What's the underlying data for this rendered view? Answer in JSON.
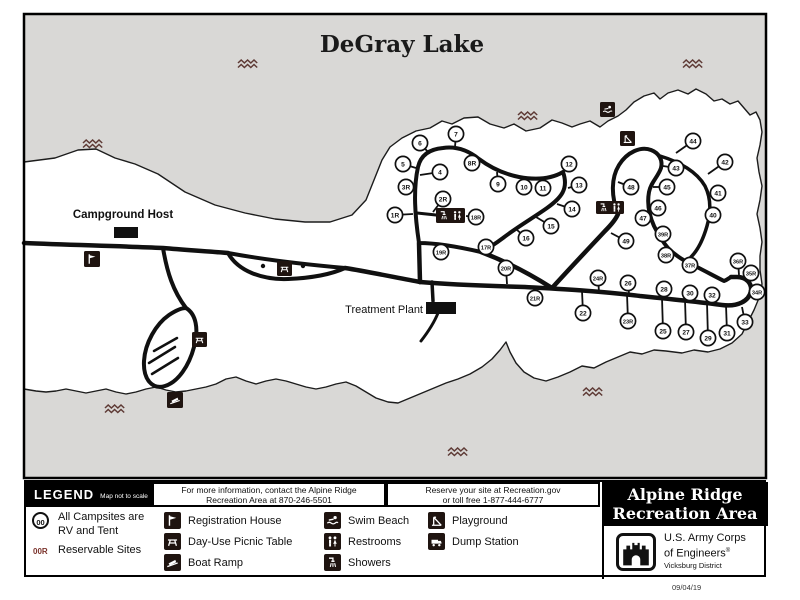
{
  "title": "DeGray Lake",
  "date_stamp": "09/04/19",
  "colors": {
    "lake": "#d9d8d6",
    "land": "#ffffff",
    "road": "#101010",
    "wave": "#5e3a35",
    "reservable": "#7b332c"
  },
  "map": {
    "campground_host_label": "Campground Host",
    "treatment_plant_label": "Treatment Plant",
    "sites": [
      [
        "1R",
        395,
        215,
        413,
        214
      ],
      [
        "2R",
        443,
        199,
        433,
        212
      ],
      [
        "3R",
        406,
        187,
        414,
        189
      ],
      [
        "4",
        440,
        172,
        420,
        175
      ],
      [
        "5",
        403,
        164,
        416,
        168
      ],
      [
        "6",
        420,
        143,
        428,
        152
      ],
      [
        "7",
        456,
        134,
        455,
        147
      ],
      [
        "8R",
        472,
        163,
        470,
        154
      ],
      [
        "9",
        498,
        184,
        497,
        172
      ],
      [
        "10",
        524,
        187,
        522,
        177
      ],
      [
        "11",
        543,
        188,
        543,
        178
      ],
      [
        "12",
        569,
        164,
        564,
        171
      ],
      [
        "13",
        579,
        185,
        568,
        188
      ],
      [
        "14",
        572,
        209,
        557,
        204
      ],
      [
        "15",
        551,
        226,
        536,
        217
      ],
      [
        "16",
        526,
        238,
        516,
        229
      ],
      [
        "17R",
        486,
        247,
        489,
        254
      ],
      [
        "18R",
        476,
        217,
        466,
        216
      ],
      [
        "19R",
        441,
        252,
        440,
        245
      ],
      [
        "20R",
        506,
        268,
        507,
        284
      ],
      [
        "21R",
        535,
        298,
        534,
        288
      ],
      [
        "22",
        583,
        313,
        582,
        291
      ],
      [
        "23R",
        628,
        321,
        627,
        294
      ],
      [
        "24R",
        598,
        278,
        599,
        292
      ],
      [
        "25",
        663,
        331,
        662,
        298
      ],
      [
        "26",
        628,
        283,
        629,
        294
      ],
      [
        "27",
        686,
        332,
        685,
        300
      ],
      [
        "28",
        664,
        289,
        665,
        298
      ],
      [
        "29",
        708,
        338,
        707,
        303
      ],
      [
        "30",
        690,
        293,
        691,
        301
      ],
      [
        "31",
        727,
        333,
        726,
        305
      ],
      [
        "32",
        712,
        295,
        713,
        303
      ],
      [
        "33",
        745,
        322,
        742,
        307
      ],
      [
        "34R",
        757,
        292,
        751,
        291
      ],
      [
        "35R",
        751,
        273,
        748,
        280
      ],
      [
        "36R",
        738,
        261,
        739,
        275
      ],
      [
        "37R",
        690,
        265,
        691,
        259
      ],
      [
        "38R",
        666,
        255,
        675,
        253
      ],
      [
        "39R",
        663,
        234,
        654,
        226
      ],
      [
        "40",
        713,
        215,
        710,
        216
      ],
      [
        "41",
        718,
        193,
        710,
        191
      ],
      [
        "42",
        725,
        162,
        708,
        174
      ],
      [
        "43",
        676,
        168,
        663,
        166
      ],
      [
        "44",
        693,
        141,
        676,
        153
      ],
      [
        "45",
        667,
        187,
        653,
        187
      ],
      [
        "46",
        658,
        208,
        649,
        207
      ],
      [
        "47",
        643,
        218,
        651,
        221
      ],
      [
        "48",
        631,
        187,
        618,
        182
      ],
      [
        "49",
        626,
        241,
        611,
        233
      ]
    ],
    "icons": [
      {
        "name": "registration-house-icon",
        "x": 84,
        "y": 251,
        "w": 16,
        "h": 16,
        "glyphs": [
          "flag"
        ]
      },
      {
        "name": "restrooms-showers-icon",
        "x": 436,
        "y": 208,
        "w": 29,
        "h": 15,
        "glyphs": [
          "shower",
          "restroom"
        ]
      },
      {
        "name": "day-use-picnic-table-icon",
        "x": 277,
        "y": 261,
        "w": 15,
        "h": 15,
        "glyphs": [
          "picnic"
        ]
      },
      {
        "name": "picnic-table-icon",
        "x": 192,
        "y": 332,
        "w": 15,
        "h": 15,
        "glyphs": [
          "picnic"
        ]
      },
      {
        "name": "boat-ramp-icon",
        "x": 167,
        "y": 392,
        "w": 16,
        "h": 16,
        "glyphs": [
          "boat"
        ]
      },
      {
        "name": "swim-beach-icon",
        "x": 600,
        "y": 102,
        "w": 15,
        "h": 15,
        "glyphs": [
          "swim"
        ]
      },
      {
        "name": "playground-icon",
        "x": 620,
        "y": 131,
        "w": 15,
        "h": 15,
        "glyphs": [
          "playground"
        ]
      },
      {
        "name": "showers-restrooms-icon",
        "x": 596,
        "y": 201,
        "w": 28,
        "h": 13,
        "glyphs": [
          "shower",
          "restroom"
        ]
      }
    ],
    "waves": [
      [
        83,
        140
      ],
      [
        238,
        60
      ],
      [
        683,
        60
      ],
      [
        518,
        112
      ],
      [
        105,
        405
      ],
      [
        583,
        388
      ],
      [
        448,
        448
      ]
    ]
  },
  "legend": {
    "header": "LEGEND",
    "scale_note": "Map not to scale",
    "info1_line1": "For more information, contact the Alpine Ridge",
    "info1_line2": "Recreation Area at 870-246-5501",
    "info2_line1": "Reserve your site at Recreation.gov",
    "info2_line2": "or toll free 1-877-444-6777",
    "campsites_symbol": "00",
    "campsites_line1": "All Campsites are",
    "campsites_line2": "RV and Tent",
    "reservable_symbol": "00R",
    "reservable_label": "Reservable Sites",
    "items": [
      {
        "name": "registration-house",
        "glyph": "flag",
        "label": "Registration House"
      },
      {
        "name": "day-use-picnic-table",
        "glyph": "picnic",
        "label": "Day-Use Picnic Table"
      },
      {
        "name": "boat-ramp",
        "glyph": "boat",
        "label": "Boat Ramp"
      },
      {
        "name": "swim-beach",
        "glyph": "swim",
        "label": "Swim Beach"
      },
      {
        "name": "restrooms",
        "glyph": "restroom",
        "label": "Restrooms"
      },
      {
        "name": "showers",
        "glyph": "shower",
        "label": "Showers"
      },
      {
        "name": "playground",
        "glyph": "playground",
        "label": "Playground"
      },
      {
        "name": "dump-station",
        "glyph": "dump",
        "label": "Dump Station"
      }
    ],
    "park_name_line1": "Alpine Ridge",
    "park_name_line2": "Recreation Area",
    "agency_line1": "U.S. Army Corps",
    "agency_line2": "of Engineers",
    "agency_reg": "®",
    "agency_line3": "Vicksburg District"
  }
}
